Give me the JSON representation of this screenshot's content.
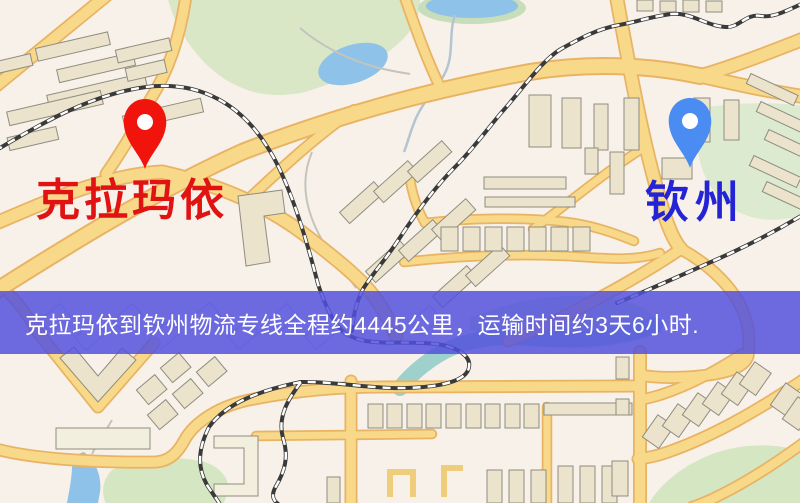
{
  "map": {
    "type": "logistics-route-map",
    "markers": {
      "origin": {
        "label": "克拉玛依",
        "pin_color": "#f0140c",
        "label_color": "#e01212"
      },
      "destination": {
        "label": "钦州",
        "pin_color": "#4a8cf2",
        "label_color": "#2423d6"
      }
    },
    "banner": {
      "text": "克拉玛依到钦州物流专线全程约4445公里，运输时间约3天6小时.",
      "distance_km": "4445",
      "duration": "3天6小时",
      "bg_color": "#5250de",
      "text_color": "#ffffff"
    },
    "colors": {
      "road": "#f8d98a",
      "road_casing": "#e9b364",
      "water": "#8fc2e8",
      "river_teal": "#9ed0cc",
      "park": "#d9e7c6",
      "building": "#ebe3cb",
      "railway": "#3a3a3a",
      "background": "#f7f1ea"
    }
  }
}
